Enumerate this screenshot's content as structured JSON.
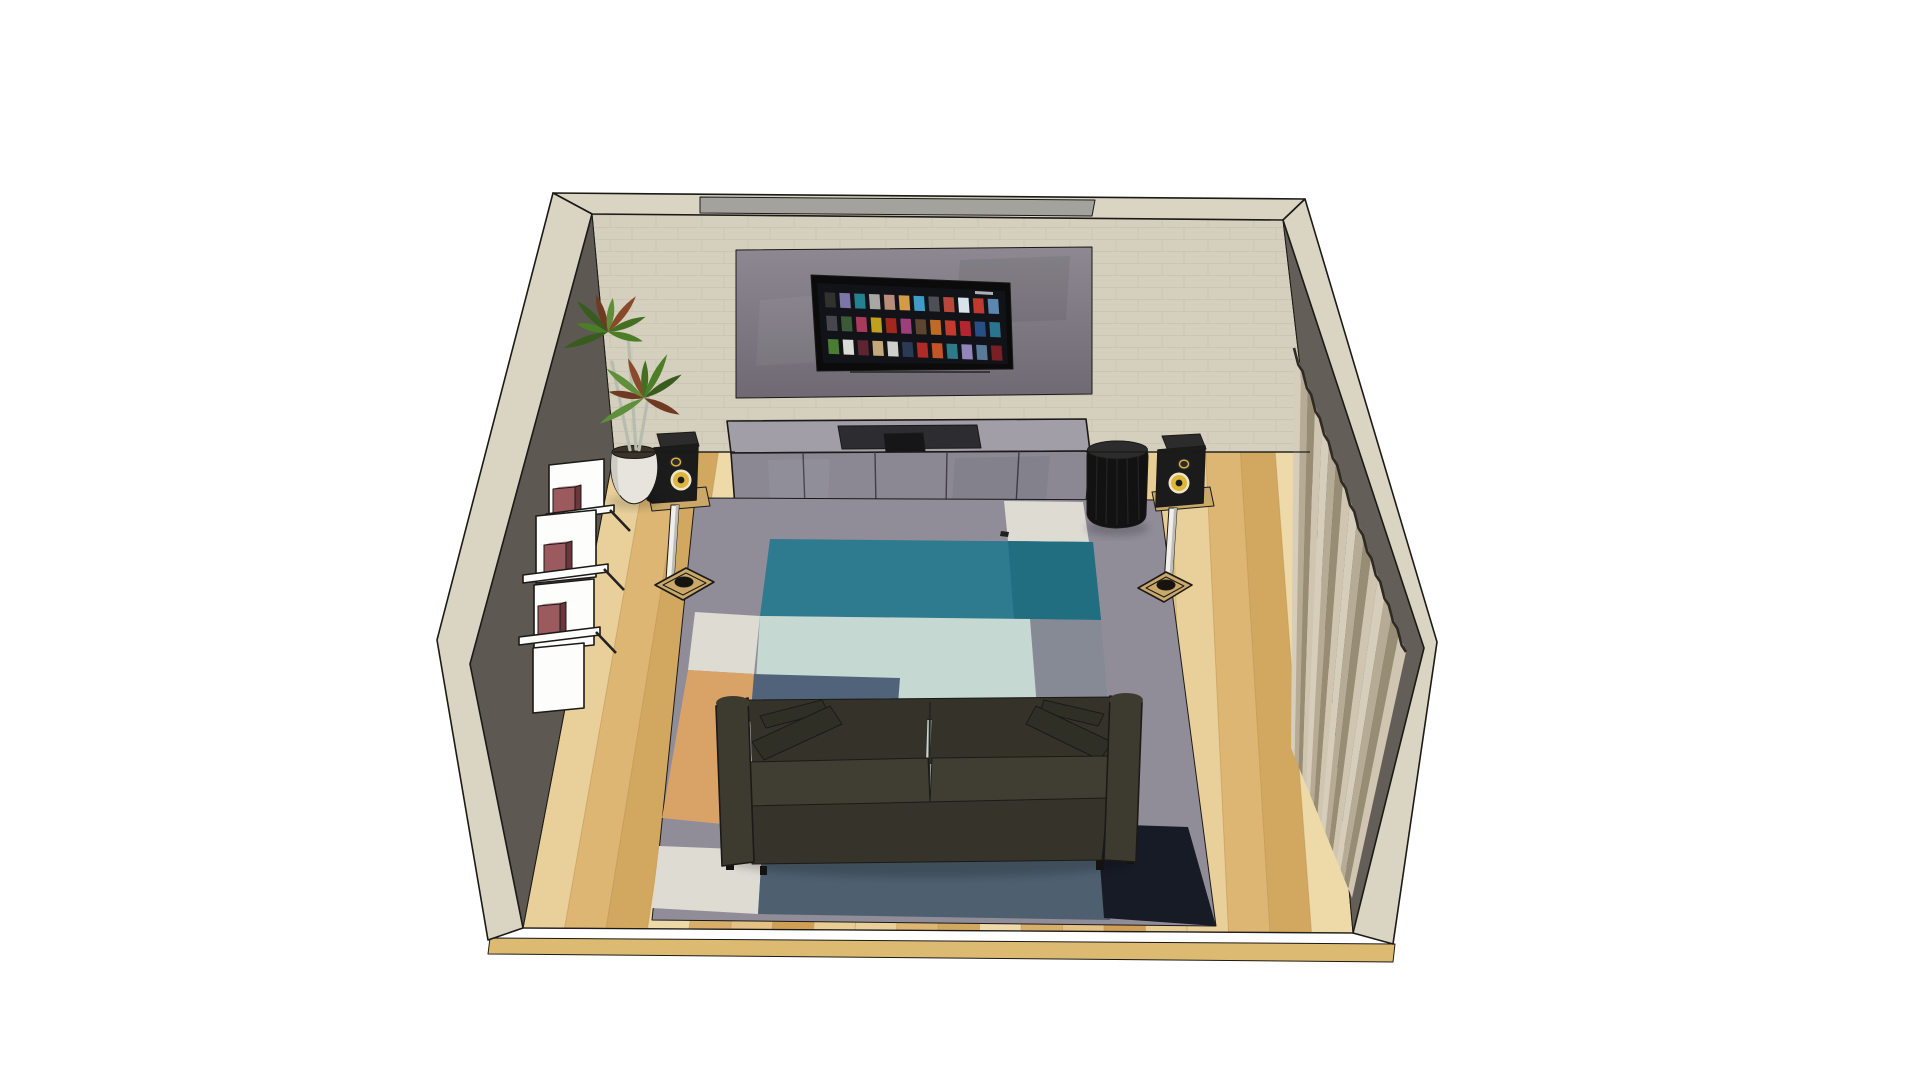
{
  "scene": {
    "viewport": "3d-room-render",
    "subject": "living-room-home-theater",
    "background": "#ffffff"
  },
  "colors": {
    "bg": "#ffffff",
    "outline": "#1b1a17",
    "wallBeige": "#d5cfbd",
    "brickLine": "#c3bdaa",
    "bandBeige": "#dad4c2",
    "capGray": "#a3a29d",
    "wallLeft": "#5d5952",
    "wallRight": "#635f58",
    "panelA": "#8d8891",
    "panelB": "#6e6972",
    "tvFrame": "#0b0b0c",
    "tvScreen": "#121318",
    "consoleTop": "#a19ea8",
    "consoleFront": "#8b8893",
    "consoleSeam": "#403e46",
    "trayDark": "#2d2c31",
    "deviceBlack": "#161618",
    "floorBase": "#e2c183",
    "slabEdge": "#ddba71",
    "plankSeam": "#b98f4e",
    "rugGray": "#908d98",
    "rugIvory": "#dedbd3",
    "rugTeal": "#2e7a8e",
    "rugTealDeep": "#206e80",
    "rugSeafoam": "#c5d9d2",
    "rugGrayBlue": "#868a95",
    "rugOrange": "#d9a368",
    "rugSteel": "#51637b",
    "rugSlate": "#4e6070",
    "rugNavy": "#171b26",
    "sofaBody": "#3a382d",
    "sofaArm": "#3d3b30",
    "sofaBack": "#343229",
    "sofaPillow": "#302f26",
    "sofaSeat": "#403e32",
    "sofaSkirt": "#36342a",
    "sofaShadow": "#141310",
    "speakerBody": "#1b1b1b",
    "speakerTop": "#2c2c2c",
    "coneYellow": "#dfb63c",
    "coneRing": "#efe6c8",
    "standWhite": "#f0efe9",
    "standShade": "#bdbcb6",
    "plateTan": "#c9a86a",
    "flangeDark": "#17140f",
    "subBlack": "#121212",
    "subSheen": "#2d2d2d",
    "potWhite": "#e6e4dd",
    "potShade": "#cdccc4",
    "soil": "#3c332b",
    "trunk": "#b7bdae",
    "stemRed": "#a7503a",
    "shelfWhite": "#fdfdfb",
    "bookFace": "#9b5a5e",
    "bookSide": "#6b373c",
    "bookTop": "#b5898c",
    "curtainA": "#d6cdba",
    "curtainB": "#b6ab94",
    "curtainC": "#978c74",
    "curtainD": "#cfc5b0",
    "curtainTop": "#2e2b24",
    "screenLogo": "#c9cdd2"
  },
  "tv": {
    "rows": 3,
    "cols": 12,
    "posters": [
      "#33302e",
      "#7d74a8",
      "#24818f",
      "#a9a7a4",
      "#b98d79",
      "#d29c45",
      "#3f9cc6",
      "#4e4e55",
      "#b8473c",
      "#d8e2ea",
      "#c0392f",
      "#5b87b0",
      "#46464c",
      "#3c5a36",
      "#a83a5c",
      "#bfa11f",
      "#a2271d",
      "#9c3f7a",
      "#5c4630",
      "#c06a24",
      "#c23b2e",
      "#b32630",
      "#274f86",
      "#2a7490",
      "#4a7c33",
      "#dcdcd6",
      "#5e2430",
      "#c4a878",
      "#cfcfcb",
      "#2a3a55",
      "#b02b25",
      "#c25425",
      "#2e7a86",
      "#9186bb",
      "#5a7a9a",
      "#7a1f26"
    ]
  },
  "floor": {
    "plank_count": 20,
    "plank_colors": [
      "#e9d09a",
      "#ddb674",
      "#d2a75f",
      "#eed9a9",
      "#d8af6a",
      "#e4c185",
      "#cf9f55",
      "#e8cd94"
    ]
  },
  "curtain": {
    "pleat_count": 16,
    "stripe_colors": [
      "#d6cdba",
      "#b6ab94",
      "#978c74",
      "#cfc5b0"
    ]
  },
  "plant": {
    "leaf_colors": [
      "#4c7d27",
      "#375c1e",
      "#6e3a22",
      "#5f8f3a",
      "#8a4a2a",
      "#446f22"
    ]
  }
}
